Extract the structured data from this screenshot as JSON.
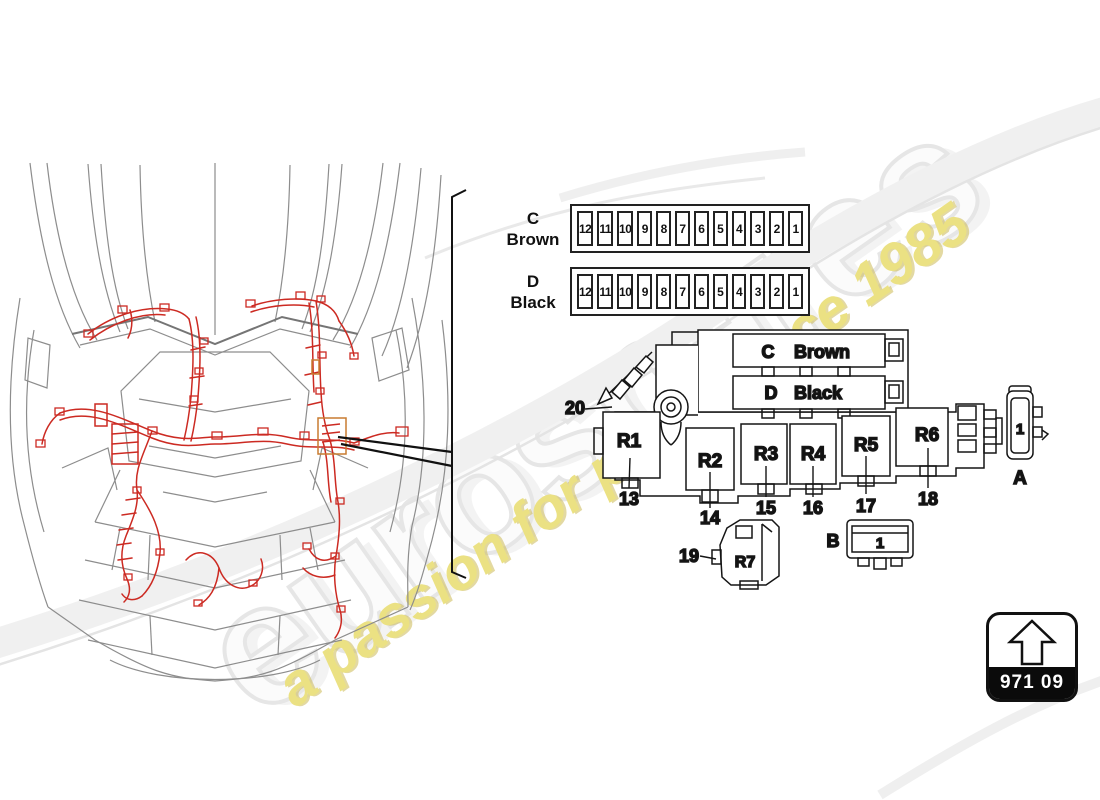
{
  "watermark": {
    "brand": "eurospares",
    "tagline": "a passion for parts since 1985",
    "brand_color": "#f0f0f0",
    "tagline_color": "#ebe183"
  },
  "diagram_colors": {
    "harness_red": "#cc2a22",
    "car_wireframe_grey": "#8d8d8d",
    "line_black": "#151515",
    "connector_orange": "#c87c30"
  },
  "fuse_rows": [
    {
      "letter": "C",
      "name": "Brown",
      "fuses": [
        "12",
        "11",
        "10",
        "9",
        "8",
        "7",
        "6",
        "5",
        "4",
        "3",
        "2",
        "1"
      ]
    },
    {
      "letter": "D",
      "name": "Black",
      "fuses": [
        "12",
        "11",
        "10",
        "9",
        "8",
        "7",
        "6",
        "5",
        "4",
        "3",
        "2",
        "1"
      ]
    }
  ],
  "fusebox": {
    "slots": [
      {
        "letter": "C",
        "name": "Brown"
      },
      {
        "letter": "D",
        "name": "Black"
      }
    ],
    "relays": [
      {
        "label": "R1",
        "callout": "13"
      },
      {
        "label": "R2",
        "callout": "14"
      },
      {
        "label": "R3",
        "callout": "15"
      },
      {
        "label": "R4",
        "callout": "16"
      },
      {
        "label": "R5",
        "callout": "17"
      },
      {
        "label": "R6",
        "callout": "18"
      }
    ],
    "mount_callout": "20"
  },
  "relay7": {
    "label": "R7",
    "callout": "19"
  },
  "part_a": {
    "label": "A",
    "value": "1"
  },
  "part_b": {
    "label": "B",
    "value": "1"
  },
  "part_number_badge": {
    "number": "971 09"
  }
}
